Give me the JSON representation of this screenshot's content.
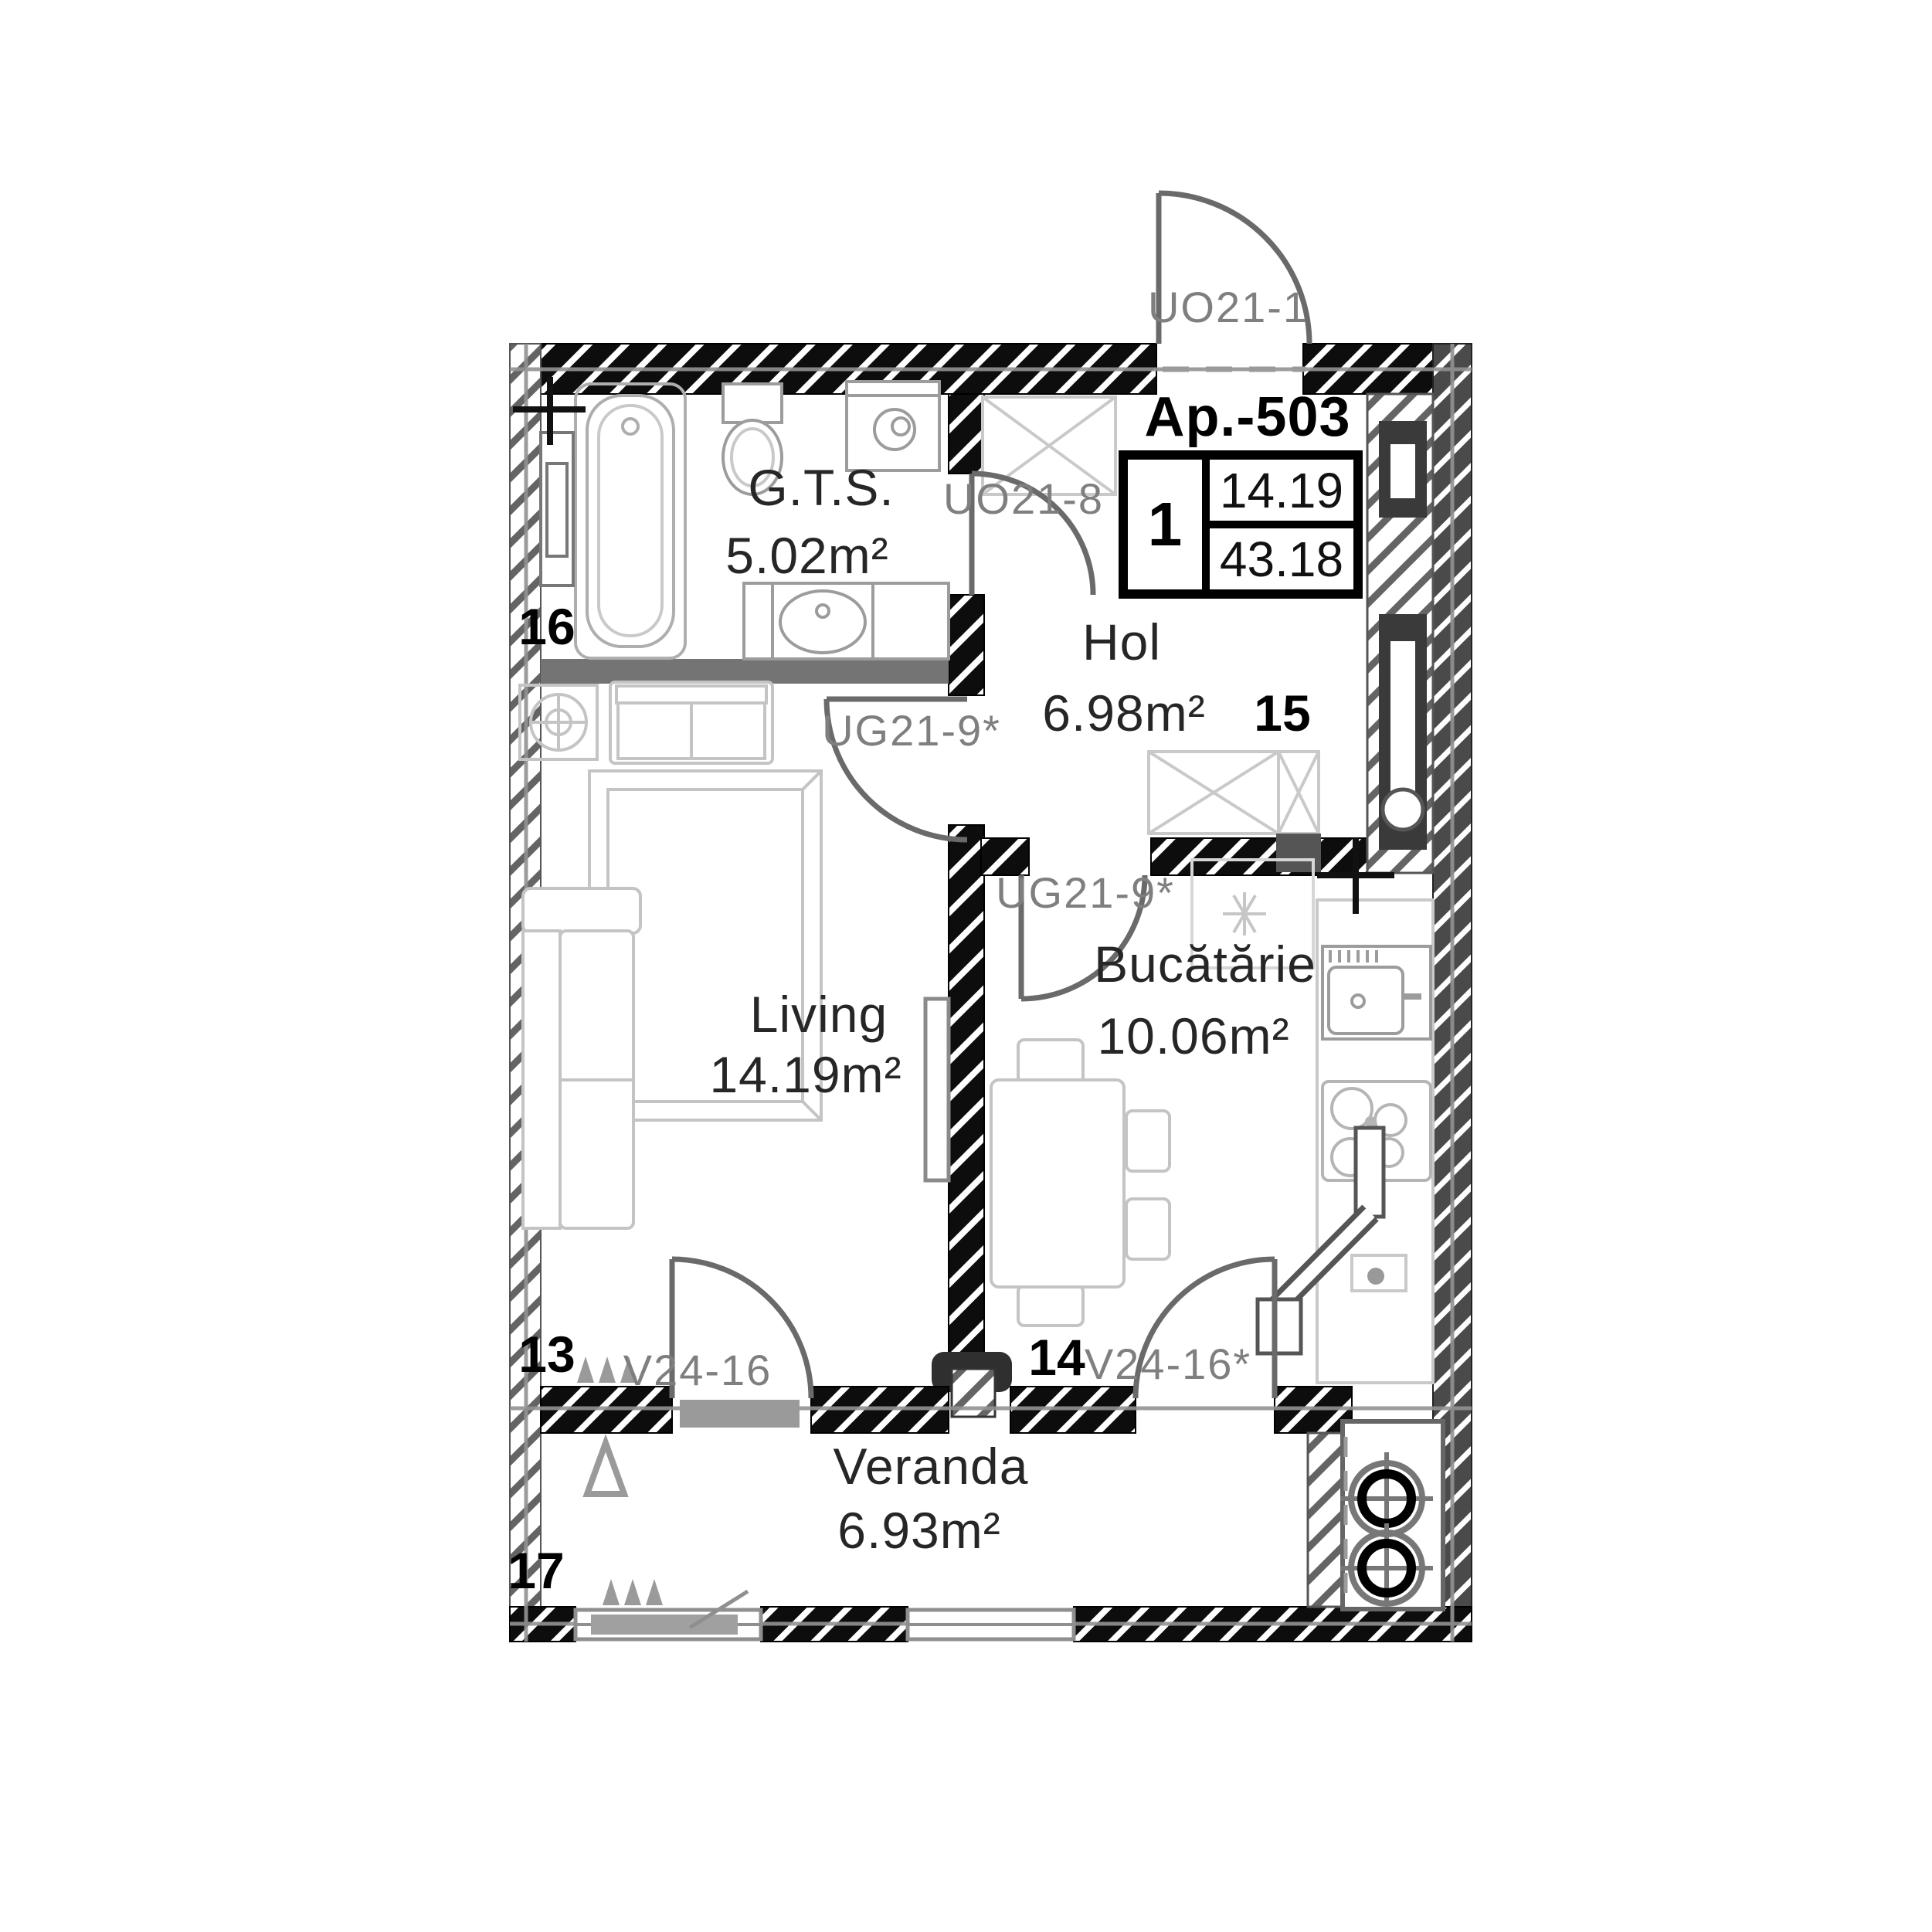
{
  "plan": {
    "apartment": {
      "title": "Ap.-503"
    },
    "summary_box": {
      "rooms_count": "1",
      "room_area": "14.19",
      "total_area": "43.18"
    },
    "rooms": [
      {
        "name": "G.T.S.",
        "area": "5.02m²"
      },
      {
        "name": "Hol",
        "area": "6.98m²"
      },
      {
        "name": "Living",
        "area": "14.19m²"
      },
      {
        "name": "Bucătărie",
        "area": "10.06m²"
      },
      {
        "name": "Veranda",
        "area": "6.93m²"
      }
    ],
    "door_labels": {
      "entry": "UO21-1",
      "bathroom": "UO21-8",
      "living": "UG21-9*",
      "kitchen": "UG21-9*",
      "veranda_living": "V24-16",
      "veranda_kitchen": "V24-16*"
    },
    "position_markers": {
      "living": "13",
      "kitchen": "14",
      "hol": "15",
      "bathroom": "16",
      "veranda": "17"
    },
    "colors": {
      "wall_black": "#0d0d0d",
      "wall_gray": "#646464",
      "text_dark": "#262626",
      "text_gray": "#7f7f7f"
    }
  }
}
